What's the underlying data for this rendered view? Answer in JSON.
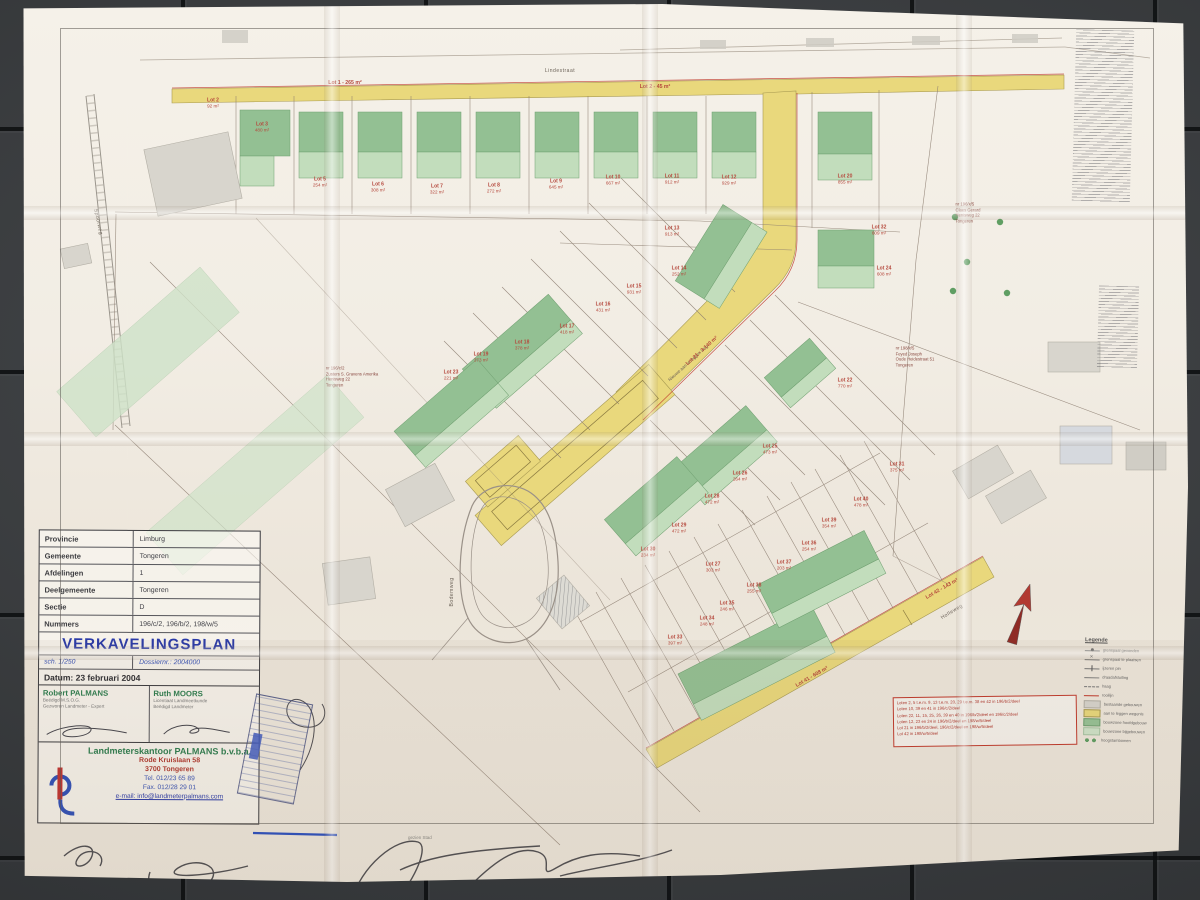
{
  "document_type": "Verkavelingsplan (photographed paper plan)",
  "title_block": {
    "rows": [
      {
        "label": "Provincie",
        "value": "Limburg"
      },
      {
        "label": "Gemeente",
        "value": "Tongeren"
      },
      {
        "label": "Afdelingen",
        "value": "1"
      },
      {
        "label": "Deelgemeente",
        "value": "Tongeren"
      },
      {
        "label": "Sectie",
        "value": "D"
      },
      {
        "label": "Nummers",
        "value": "196/c/2, 196/b/2, 198/w/5"
      }
    ],
    "plan_title": "VERKAVELINGSPLAN",
    "scale_label": "sch. 1/250",
    "dossier_label": "Dossiernr.: 2004000",
    "date_label": "Datum: 23 februari 2004",
    "surveyor_left": {
      "name": "Robert PALMANS",
      "line1": "Beëdigd M.S.O.G.",
      "line2": "Gezworen Landmeter - Expert"
    },
    "surveyor_right": {
      "name": "Ruth MOORS",
      "line1": "Licentiaat Landmeetkunde",
      "line2": "Beëdigd Landmeter"
    },
    "company": {
      "name": "Landmeterskantoor PALMANS b.v.b.a.",
      "address1": "Rode Kruislaan 58",
      "address2": "3700 Tongeren",
      "tel": "Tel. 012/23 65 89",
      "fax": "Fax. 012/28 29 01",
      "email": "e-mail: info@landmeterpalmans.com"
    }
  },
  "plan": {
    "streets": [
      {
        "name": "Lindestraat"
      },
      {
        "name": "Holleweg"
      },
      {
        "name": "Bodemweg"
      },
      {
        "name": "Spoorweg"
      }
    ],
    "road_labels": [
      {
        "text": "Lot 1 - 265 m²"
      },
      {
        "text": "Lot 2 - 45 m²"
      },
      {
        "text": "Nieuwe aan te leggen weg"
      },
      {
        "text": "Lot 21 - 3.140 m²"
      },
      {
        "text": "Lot 41 - 608 m²"
      },
      {
        "text": "Lot 42 - 143 m²"
      }
    ],
    "lot_labels": [
      {
        "id": "Lot 2",
        "area": "92 m²"
      },
      {
        "id": "Lot 3",
        "area": "480 m²"
      },
      {
        "id": "Lot 5",
        "area": "254 m²"
      },
      {
        "id": "Lot 6",
        "area": "308 m²"
      },
      {
        "id": "Lot 7",
        "area": "322 m²"
      },
      {
        "id": "Lot 8",
        "area": "272 m²"
      },
      {
        "id": "Lot 9",
        "area": "645 m²"
      },
      {
        "id": "Lot 10",
        "area": "667 m²"
      },
      {
        "id": "Lot 11",
        "area": "912 m²"
      },
      {
        "id": "Lot 12",
        "area": "929 m²"
      },
      {
        "id": "Lot 20",
        "area": "855 m²"
      },
      {
        "id": "Lot 13",
        "area": "913 m²"
      },
      {
        "id": "Lot 14",
        "area": "252 m²"
      },
      {
        "id": "Lot 15",
        "area": "931 m²"
      },
      {
        "id": "Lot 16",
        "area": "431 m²"
      },
      {
        "id": "Lot 17",
        "area": "418 m²"
      },
      {
        "id": "Lot 18",
        "area": "378 m²"
      },
      {
        "id": "Lot 19",
        "area": "373 m²"
      },
      {
        "id": "Lot 23",
        "area": "221 m²"
      },
      {
        "id": "Lot 32",
        "area": "609 m²"
      },
      {
        "id": "Lot 24",
        "area": "608 m²"
      },
      {
        "id": "Lot 22",
        "area": "770 m²"
      },
      {
        "id": "Lot 25",
        "area": "473 m²"
      },
      {
        "id": "Lot 26",
        "area": "264 m²"
      },
      {
        "id": "Lot 28",
        "area": "472 m²"
      },
      {
        "id": "Lot 29",
        "area": "472 m²"
      },
      {
        "id": "Lot 31",
        "area": "375 m²"
      },
      {
        "id": "Lot 40",
        "area": "478 m²"
      },
      {
        "id": "Lot 39",
        "area": "354 m²"
      },
      {
        "id": "Lot 36",
        "area": "254 m²"
      },
      {
        "id": "Lot 37",
        "area": "203 m²"
      },
      {
        "id": "Lot 38",
        "area": "255 m²"
      },
      {
        "id": "Lot 35",
        "area": "246 m²"
      },
      {
        "id": "Lot 34",
        "area": "248 m²"
      },
      {
        "id": "Lot 33",
        "area": "397 m²"
      },
      {
        "id": "Lot 30",
        "area": "234 m²"
      },
      {
        "id": "Lot 27",
        "area": "303 m²"
      }
    ],
    "owner_notes": [
      {
        "lines": [
          "nr 196/c/2",
          "Zusters S. Gravens Amerika",
          "Henisweg 22",
          "Tongeren"
        ]
      },
      {
        "lines": [
          "nr 196/x/5",
          "Claes Gerard",
          "Henisweg 22",
          "Tongeren"
        ]
      },
      {
        "lines": [
          "nr 198/x/5",
          "Feyed Joseph",
          "Oude Heidestraat 51",
          "Tongeren"
        ]
      }
    ],
    "notes_box_lines": [
      "Loten 2, 5 t.e.m. 9, 13 t.e.m. 20, 29 t.e.m. 38 en 42 in 196/b/2/deel",
      "Loten 10, 39 en 41 in 196/c/2/deel",
      "Loten 22, 11, 15, 25, 26, 39 en 40 in 196/b/2/deel en 196/c/2/deel",
      "Loten 12, 23 en 24 in 196/b/2/deel en 198/w/5/deel",
      "Lot 21 in 196/b/2/deel, 196/c/2/deel en 198/w/5/deel",
      "Lot 42 in 198/w/5/deel"
    ],
    "legend": {
      "title": "Legende",
      "items": [
        {
          "sym": "s-dot",
          "label": "grenspaal gevonden"
        },
        {
          "sym": "s-cross",
          "label": "grenspaal te plaatsen"
        },
        {
          "sym": "s-tick",
          "label": "ijzeren pin"
        },
        {
          "sym": "s-line",
          "label": "draadafsluiting"
        },
        {
          "sym": "s-dash",
          "label": "haag"
        },
        {
          "sym": "s-red",
          "label": "rooilijn"
        },
        {
          "sym": "s-sw-gr",
          "label": "bestaande gebouwen"
        },
        {
          "sym": "s-sw-y",
          "label": "aan te leggen wegenis"
        },
        {
          "sym": "s-sw-g",
          "label": "bouwzone hoofdgebouw"
        },
        {
          "sym": "s-sw-lg",
          "label": "bouwzone bijgebouwen"
        },
        {
          "sym": "s-dots",
          "label": "hoogstambomen"
        }
      ]
    },
    "margin_note": "gezien Stad"
  },
  "colors": {
    "road_yellow": "#e9d87c",
    "building_green": "#93c093",
    "building_green_light": "#c2ddbc",
    "label_red": "#b5483c",
    "title_blue": "#2a3aa8",
    "name_green": "#2e7d4f",
    "floor_dark": "#3a3d40"
  }
}
